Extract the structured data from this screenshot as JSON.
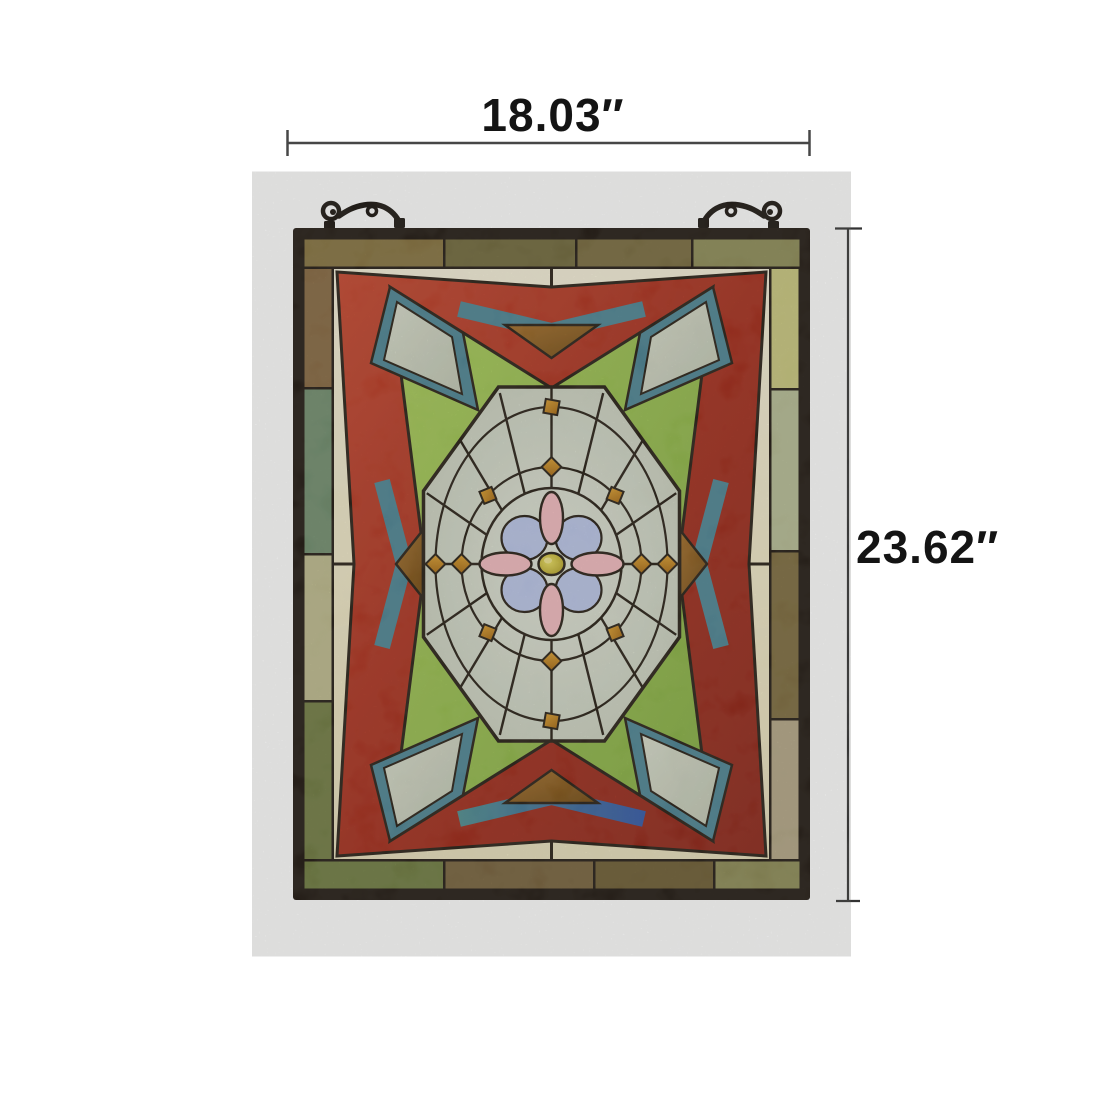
{
  "dimensions": {
    "width_label": "18.03″",
    "height_label": "23.62″"
  },
  "palette": {
    "frame": "#1f1710",
    "lead": "#241c12",
    "red": "#a52a18",
    "red_light": "#c5432a",
    "red_dark": "#7e1d10",
    "teal": "#4a8292",
    "royal_blue": "#3356a2",
    "brown_amber": "#95621f",
    "amber_jewel": "#c8881a",
    "green": "#96bf49",
    "clear_glass": "#ccd3c3",
    "cream": "#f2ebcf",
    "pink": "#f2b9bd",
    "lavender": "#b9c4e7",
    "center_jewel": "#c8b92e",
    "hook_iron": "#17110c",
    "dimension_line": "#474747",
    "label_text": "#141414",
    "border_strips": {
      "top": [
        "#85713d",
        "#6e6638",
        "#77693c",
        "#8c8a55"
      ],
      "left": [
        "#85663e",
        "#6f8c6c",
        "#bcb98b",
        "#6f7a40"
      ],
      "right": [
        "#c9c77d",
        "#b5bb93",
        "#7c6a3c",
        "#b2a584"
      ],
      "bottom": [
        "#6d7a3e",
        "#75603a",
        "#6b5a30",
        "#8c8a55"
      ]
    }
  }
}
